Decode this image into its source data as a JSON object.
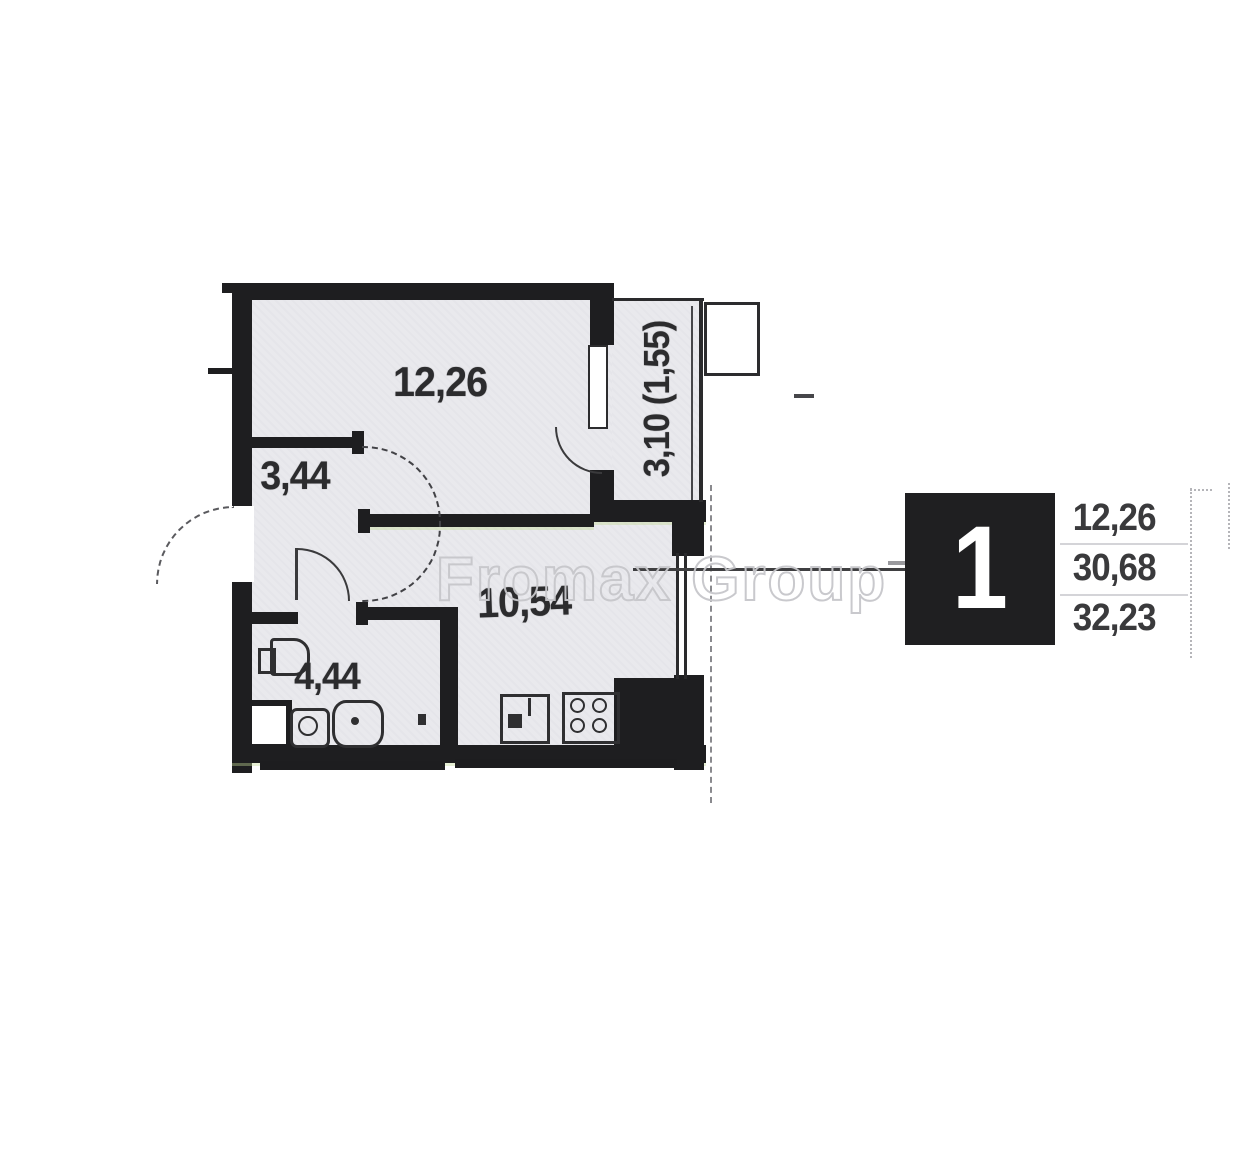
{
  "watermark": {
    "text": "Fromax Group"
  },
  "rooms": [
    {
      "id": "living-room",
      "area": "12,26"
    },
    {
      "id": "hallway",
      "area": "3,44"
    },
    {
      "id": "kitchen",
      "area": "10,54"
    },
    {
      "id": "bathroom",
      "area": "4,44"
    },
    {
      "id": "balcony",
      "area": "3,10 (1,55)"
    }
  ],
  "legend": {
    "room_count": "1",
    "values": [
      "12,26",
      "30,68",
      "32,23"
    ]
  },
  "colors": {
    "wall": "#1e1e20",
    "room_fill": "#e9e9ed",
    "label_text": "#2c2c2e",
    "watermark_outline": "#c7c7cb",
    "legend_box": "#1f1f21"
  }
}
